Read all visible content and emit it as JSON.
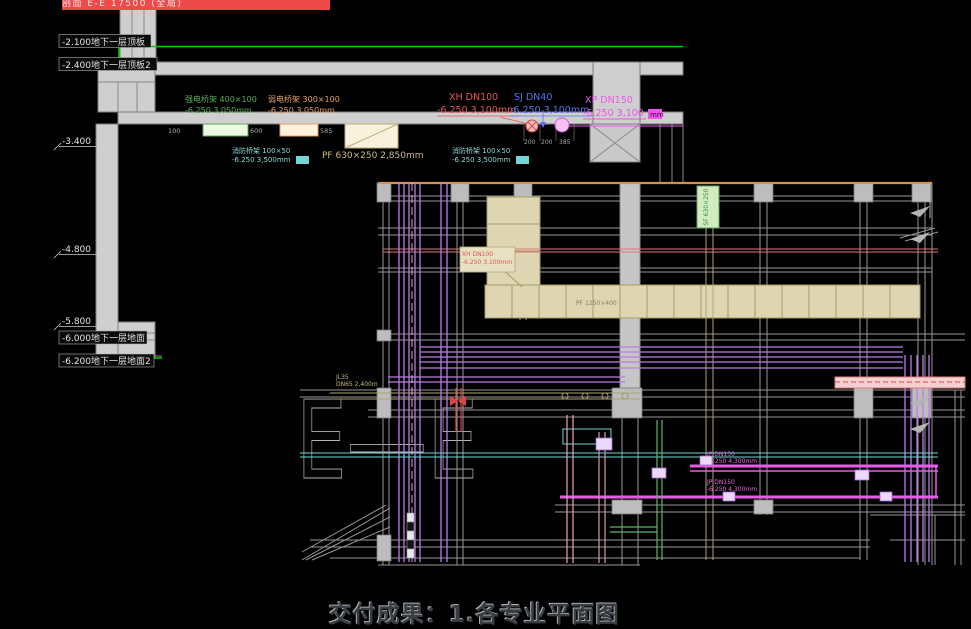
{
  "banner": {
    "text": "剖面 E-E 17500 (全局)"
  },
  "caption": {
    "text": "交付成果：1.各专业平面图"
  },
  "section": {
    "letters": "E—E",
    "elevations": [
      {
        "text": "-2.100地下一层顶板"
      },
      {
        "text": "-2.400地下一层顶板2"
      },
      {
        "text": "-3.400"
      },
      {
        "text": "-4.800"
      },
      {
        "text": "-5.800"
      },
      {
        "text": "-6.000地下一层地面"
      },
      {
        "text": "-6.200地下一层地面2"
      }
    ],
    "strong_tray": {
      "line1": "强电桥架 400×100",
      "line2": "-6.250 3,050mm"
    },
    "weak_tray": {
      "line1": "弱电桥架 300×100",
      "line2": "-6.250 3,050mm"
    },
    "fire_tray_left": {
      "line1": "消防桥架 100×50",
      "line2": "-6.250 3,500mm"
    },
    "fire_tray_right": {
      "line1": "消防桥架 100×50",
      "line2": "-6.250 3,500mm"
    },
    "pf_duct": {
      "text": "PF 630×250  2,850mm"
    },
    "xh": {
      "line1": "XH  DN100",
      "line2": "-6.250 3,100mm"
    },
    "sj": {
      "line1": "SJ  DN40",
      "line2": "-6.250 3,100mm"
    },
    "xp": {
      "line1": "XP  DN150",
      "line2": "-6.250 3,100",
      "unit": "mm"
    },
    "tray_dims": [
      "100",
      "600",
      "585"
    ],
    "pipe_dims": [
      "200",
      "200",
      "385"
    ]
  },
  "plan": {
    "xh_branch": {
      "line1": "XH DN100",
      "line2": "-6.250 3,100mm"
    },
    "jl_label": {
      "line1": "JL35",
      "line2": "DN65 2,400m"
    },
    "jp_upper": {
      "line1": "JP DN150",
      "line2": "-6.250 4,300mm"
    },
    "jp_lower": {
      "line1": "JP DN150",
      "line2": "-6.250 4,300mm"
    },
    "duct_vertical_label": "SF 630×250",
    "duct_run_label": "PF 1250×400"
  }
}
